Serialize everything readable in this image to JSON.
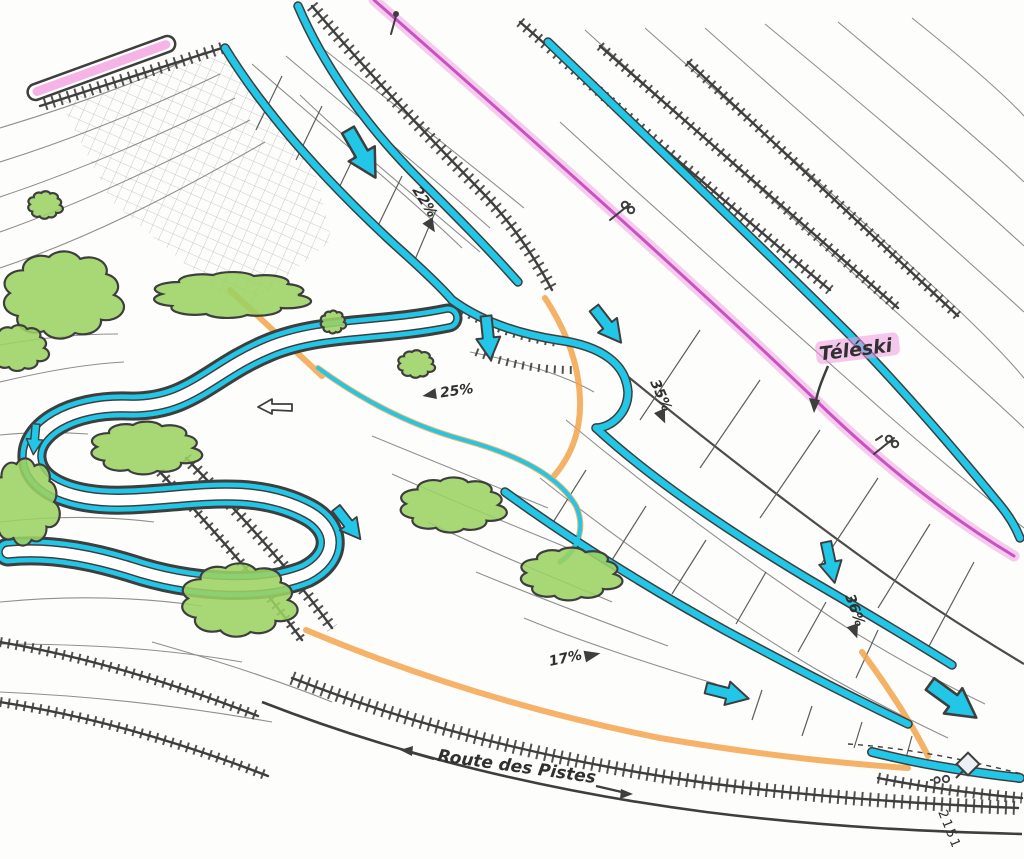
{
  "colors": {
    "piste": "#22c6e6",
    "lift_highlight": "#f09ae2",
    "lift_core": "#c445bb",
    "vegetation": "#9cd162",
    "cut_fill": "#f3a54e",
    "ink": "#3e3e3e",
    "contour": "#8f8f8f",
    "paper": "#fdfdfb"
  },
  "lift": {
    "label": "Téléski"
  },
  "road": {
    "label": "Route des Pistes"
  },
  "parcel": {
    "number": "2151"
  },
  "slope_labels": [
    {
      "value": "22%",
      "arrow": "downhill"
    },
    {
      "value": "25%",
      "arrow": "left"
    },
    {
      "value": "35%",
      "arrow": "downhill"
    },
    {
      "value": "17%",
      "arrow": "right"
    },
    {
      "value": "36%",
      "arrow": "downhill"
    }
  ],
  "icons": {
    "flow_arrow": "piste-direction-arrow",
    "pylon": "lift-pylon",
    "building": "building-diamond",
    "survey": "survey-marker",
    "turn_arrow": "junction-arrow"
  }
}
